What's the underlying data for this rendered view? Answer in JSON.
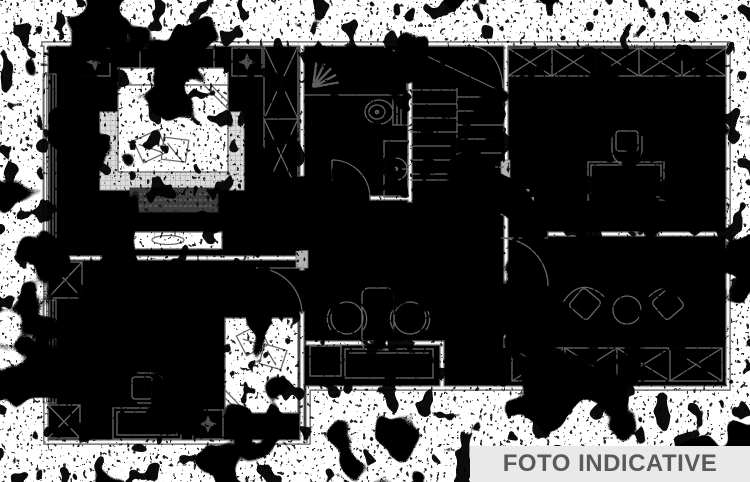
{
  "banner": {
    "label": "FOTO INDICATIVE",
    "background_color": "#e9e9e9",
    "text_color": "#5a5a5a"
  },
  "drawing": {
    "paper_color": "#ffffff",
    "wall_ink_color": "#585858",
    "furniture_ink_color": "#686868",
    "noise_color": "#000000",
    "style": "black-and-white architectural floor plan heavily corrupted by binary dithering noise"
  },
  "floor_plan": {
    "type": "apartment-floor-plan",
    "rooms": [
      {
        "name": "bedroom-top-left",
        "furniture": [
          "double-bed",
          "two-pillows",
          "folded-blanket-corner",
          "woven-rug",
          "dark-bench",
          "tall-wardrobe-x",
          "two-wall-cabinets",
          "two-ceiling-light-symbols",
          "side-window",
          "door"
        ]
      },
      {
        "name": "bathroom-center",
        "furniture": [
          "shower-with-spray-symbol",
          "toilet",
          "washbasin-unit",
          "door"
        ]
      },
      {
        "name": "staircase-center",
        "furniture": [
          "two-flight-stair-with-winder"
        ]
      },
      {
        "name": "study-top-right",
        "furniture": [
          "wardrobe-x-five-sections",
          "desk",
          "office-chair",
          "tiny-dimension-marks"
        ]
      },
      {
        "name": "bedroom-bottom-left",
        "furniture": [
          "single-bed",
          "two-pillows",
          "folded-blanket-corner",
          "chair",
          "dresser",
          "sideboard-with-dish",
          "wardrobe-x-upper",
          "wardrobe-x-lower",
          "side-window",
          "ceiling-light-symbol",
          "door"
        ]
      },
      {
        "name": "hallway-center",
        "furniture": [
          "stool-left",
          "stool-right",
          "rounded-cabinet",
          "storage-boxes"
        ]
      },
      {
        "name": "living-room-bottom-right",
        "furniture": [
          "armchair-left",
          "armchair-right",
          "round-table",
          "wardrobe-x-four-sections",
          "door"
        ]
      }
    ]
  }
}
